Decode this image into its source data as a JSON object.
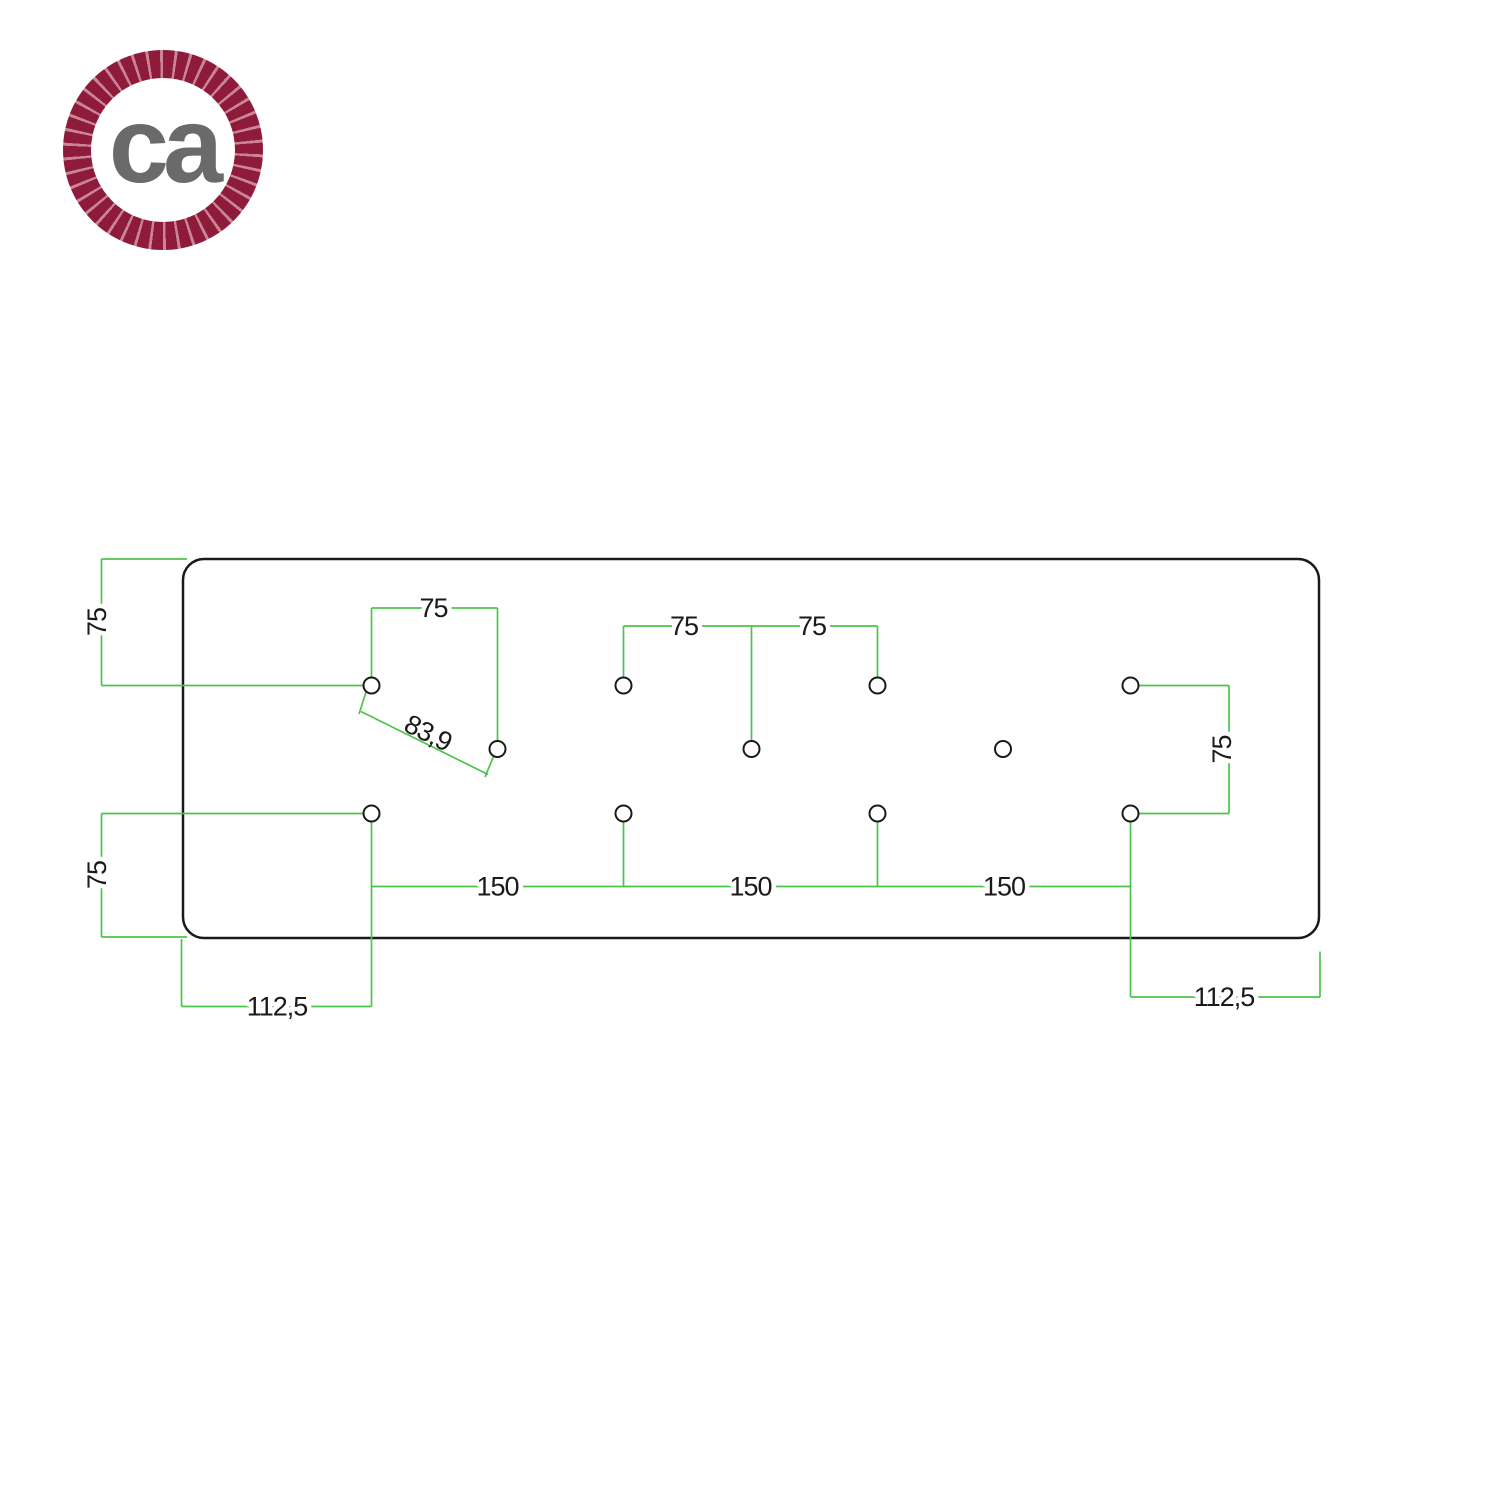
{
  "logo": {
    "text": "ca"
  },
  "colors": {
    "green": "#4cc44c",
    "ink": "#1a1a1a",
    "rope": "#8e1b3a",
    "rope-gap": "#c9849a",
    "logo-gray": "#6a6a6a"
  },
  "drawing": {
    "holes_count": 11,
    "dim_labels": {
      "left_top": "75",
      "left_bottom": "75",
      "top_left": "75",
      "diagonal": "83,9",
      "top_center_left": "75",
      "top_center_right": "75",
      "right": "75",
      "bottom_1": "150",
      "bottom_2": "150",
      "bottom_3": "150",
      "offset_left": "112,5",
      "offset_right": "112,5"
    }
  }
}
